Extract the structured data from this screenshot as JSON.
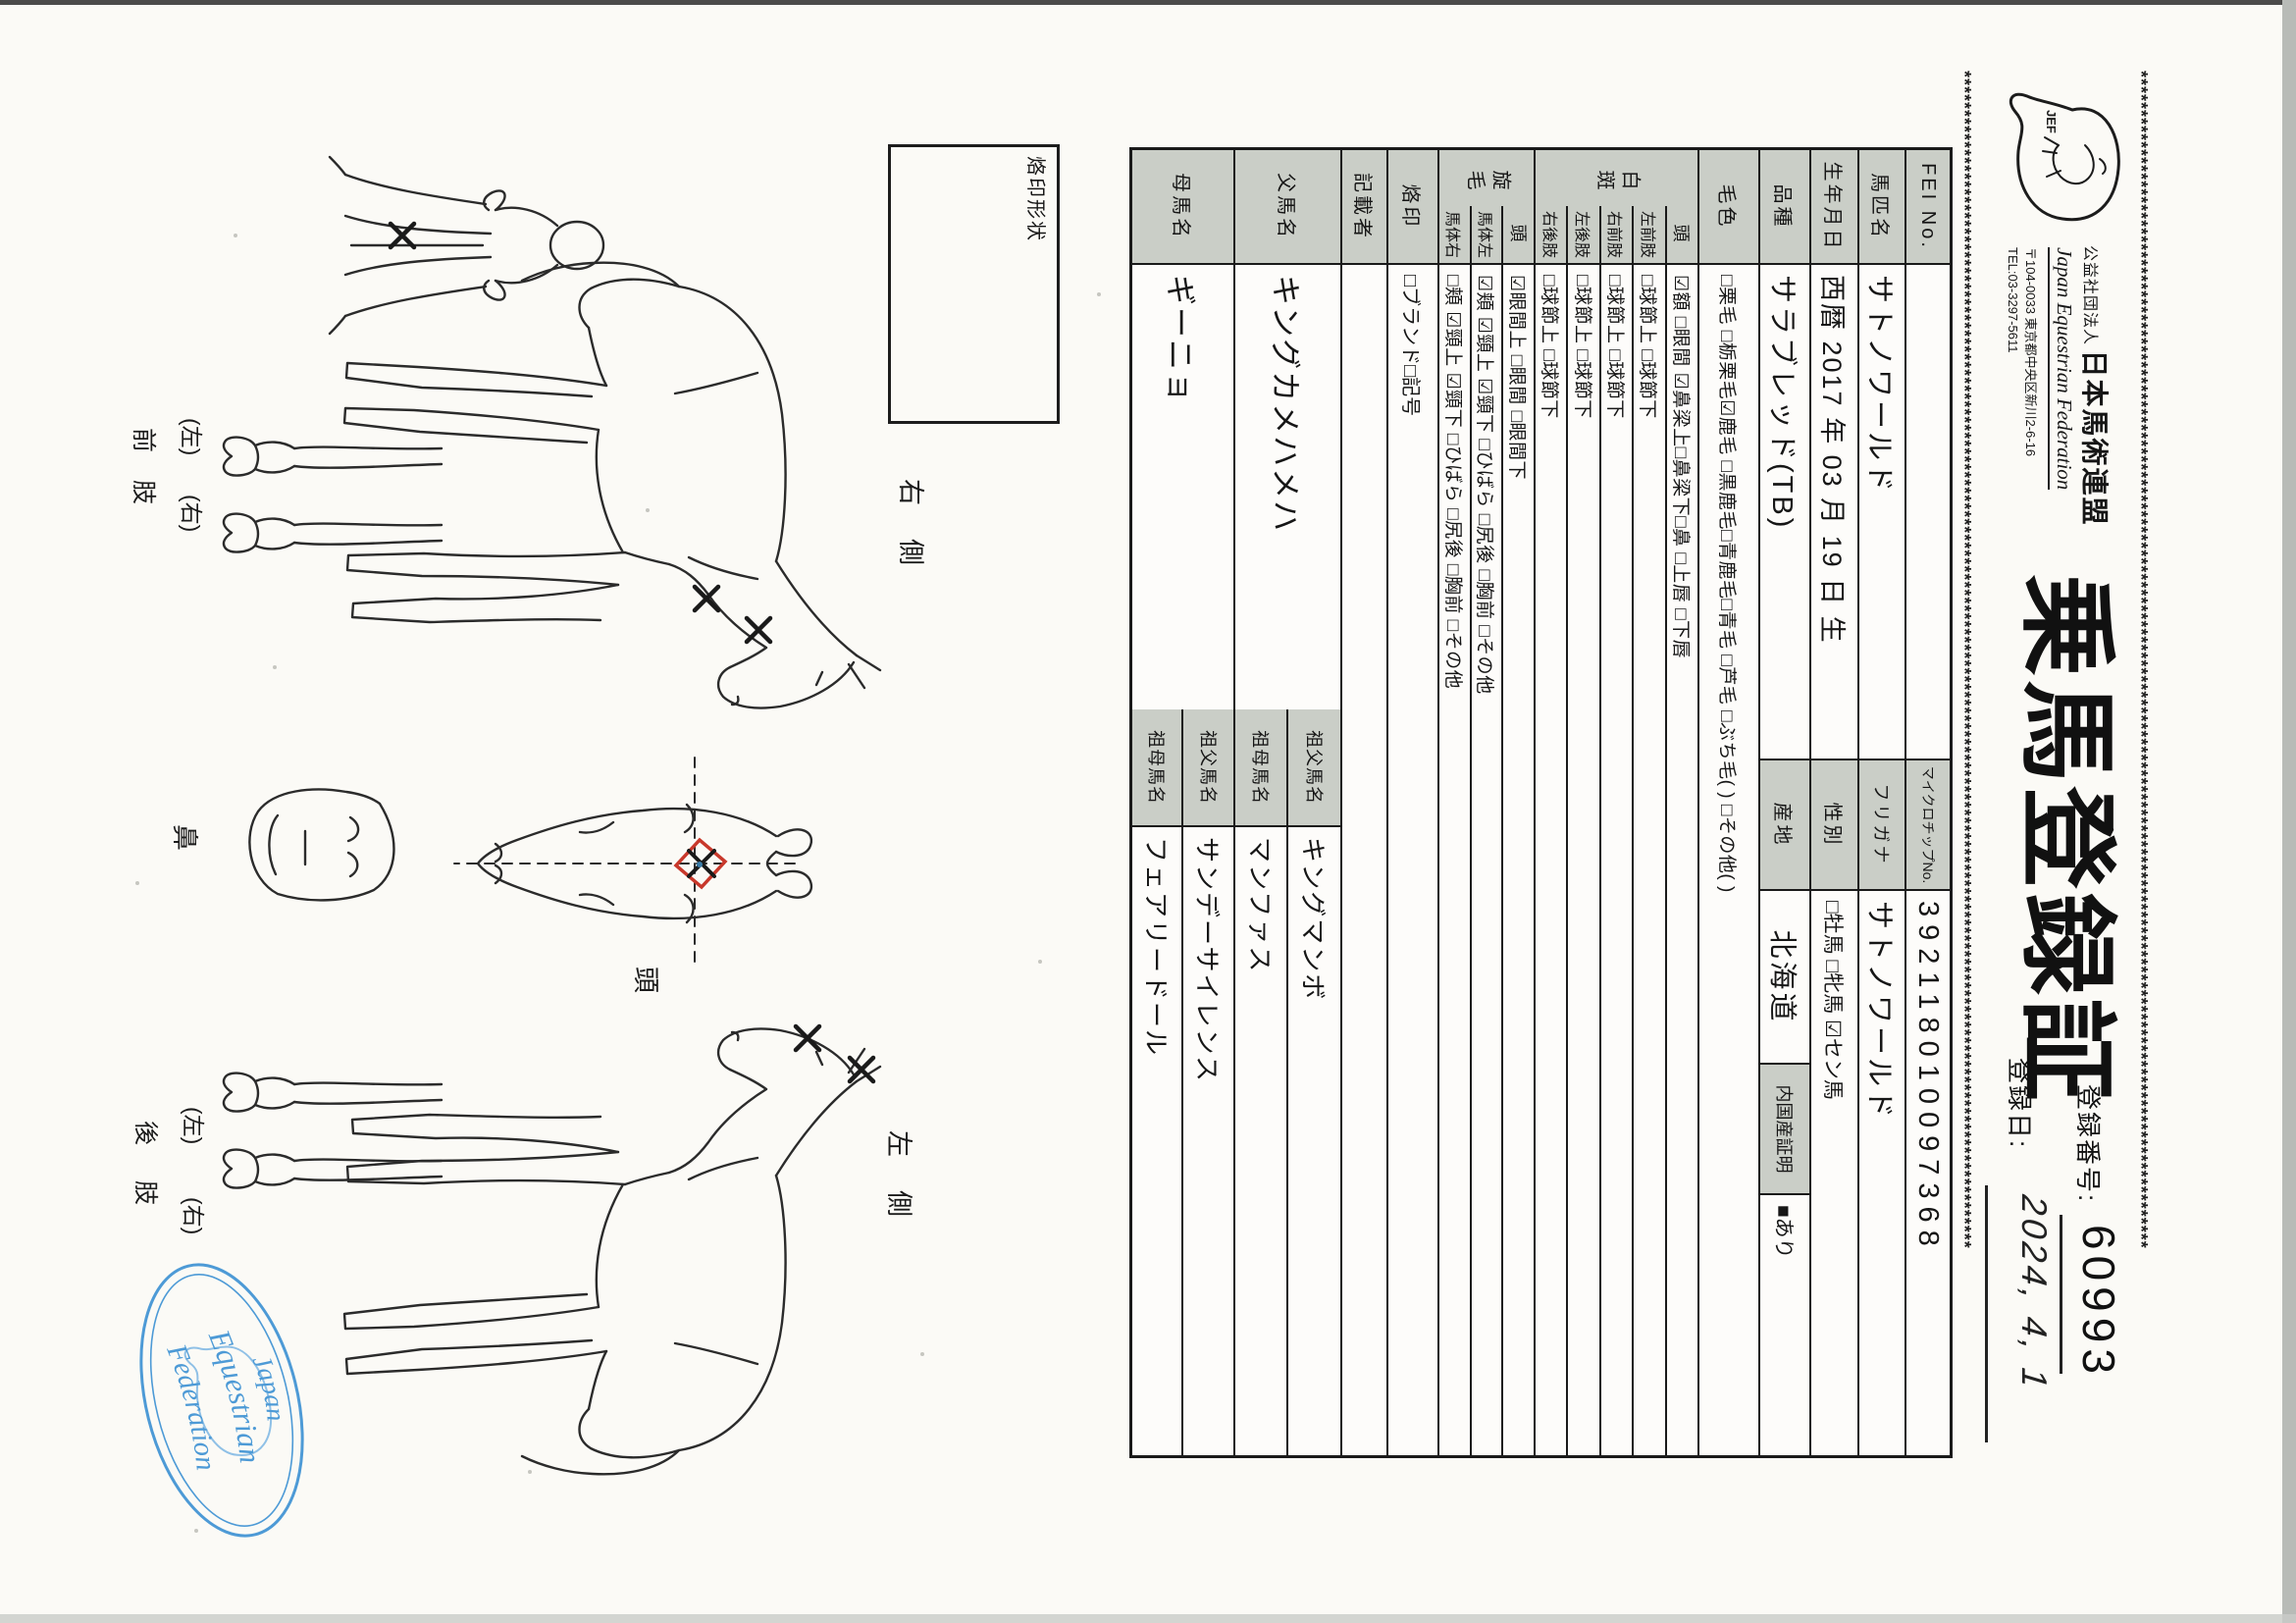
{
  "header": {
    "border_line": "******************************************************************************************************************************************************",
    "logo_text": "JEF",
    "org_type": "公益社団法人",
    "org_name": "日本馬術連盟",
    "org_name_en": "Japan Equestrian Federation",
    "org_address": "〒104-0033 東京都中央区新川2-6-16",
    "org_tel": "TEL:03-3297-5611",
    "title": "乗馬登録証",
    "reg_no_label": "登録番号:",
    "reg_no_value": "60993",
    "reg_date_label": "登録日:",
    "reg_date_value": "2024, 4, 1"
  },
  "table": {
    "fei_label": "FEI No.",
    "fei_value": "",
    "microchip_label": "マイクロチップNo.",
    "microchip_value": "392118010097368",
    "name_label": "馬匹名",
    "name_value": "サトノワールド",
    "furigana_label": "フリガナ",
    "furigana_value": "サトノワールド",
    "birth_label": "生年月日",
    "birth_value": "西暦 2017 年 03 月 19 日 生",
    "sex_label": "性別",
    "sex_value": "□牡馬  □牝馬  ☑セン馬",
    "breed_label": "品種",
    "breed_value": "サラブレッド(TB)",
    "origin_label": "産地",
    "origin_value": "北海道",
    "domestic_label": "内国産証明",
    "domestic_value": "■あり",
    "coat_label": "毛色",
    "coat_value": "□栗毛  □栃栗毛☑鹿毛  □黒鹿毛□青鹿毛□青毛  □芦毛  □ぶち毛(  )  □その他(  )",
    "hakuhan_label": "白斑",
    "hakuhan_head_label": "頭",
    "hakuhan_head_value": "☑額  □眼間  ☑鼻梁上□鼻梁下□鼻  □上唇  □下唇",
    "lf_label": "左前肢",
    "rf_label": "右前肢",
    "lh_label": "左後肢",
    "rh_label": "右後肢",
    "fetlock_value": "□球節上  □球節下",
    "senmo_label": "旋毛",
    "senmo_head_label": "頭",
    "senmo_head_value": "☑眼間上  □眼間  □眼間下",
    "body_left_label": "馬体左",
    "body_left_value": "☑頬  ☑頸上  ☑頸下  □ひばら  □尻後  □胸前  □その他",
    "body_right_label": "馬体右",
    "body_right_value": "□頬  ☑頸上  ☑頸下  □ひばら  □尻後  □胸前  □その他",
    "brand_label": "烙印",
    "brand_value": "□ブランド□記号",
    "recorder_label": "記載者",
    "recorder_value": "",
    "sire_label": "父馬名",
    "sire_value": "キングカメハメハ",
    "sire_gf_label": "祖父馬名",
    "sire_gf_value": "キングマンボ",
    "sire_gm_label": "祖母馬名",
    "sire_gm_value": "マンファス",
    "dam_label": "母馬名",
    "dam_value": "ギーニョ",
    "dam_gf_label": "祖父馬名",
    "dam_gf_value": "サンデーサイレンス",
    "dam_gm_label": "祖母馬名",
    "dam_gm_value": "フェアリードール"
  },
  "diagram": {
    "brand_box_label": "烙印形状",
    "right_side": "右側",
    "left_side": "左側",
    "head": "頭",
    "nose": "鼻",
    "front_legs": "前肢",
    "hind_legs": "後肢",
    "front_paren_left": "(左)",
    "front_paren_right": "(右)",
    "hind_paren_left": "(左)",
    "hind_paren_right": "(右)"
  },
  "stamp": {
    "word1": "Japan",
    "word2": "Equestrian",
    "word3": "Federation"
  },
  "colors": {
    "cell_shade": "#cacec7",
    "stamp_blue": "#4d9ad6",
    "red_mark": "#c8382b"
  }
}
